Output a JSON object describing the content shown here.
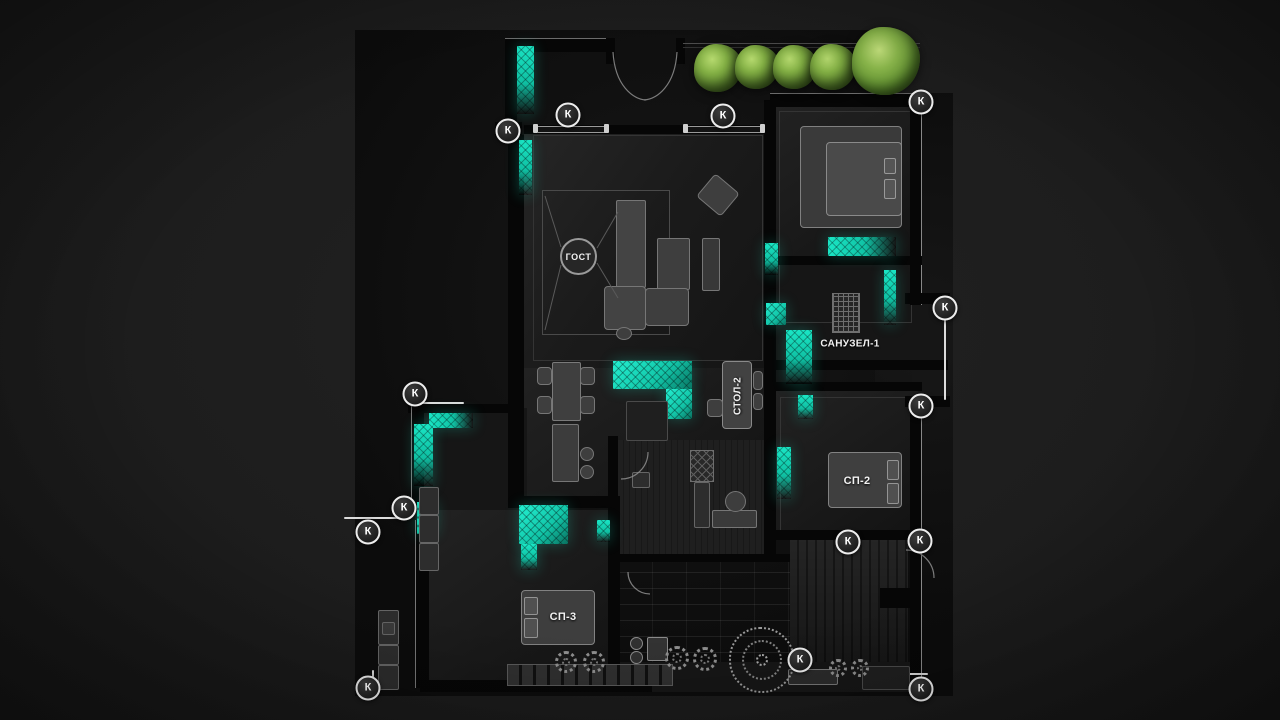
{
  "scene": {
    "type": "apartment-floor-plan-render",
    "background_color": "#1d1d1d",
    "accent_teal": "#1ae6c5",
    "tree_green": "#84b145"
  },
  "labels": {
    "living": "ГОСТ",
    "bathroom1": "САНУЗЕЛ-1",
    "table2": "СТОЛ-2",
    "bedroom2": "СП-2",
    "bedroom3": "СП-3"
  },
  "markers": {
    "letter": "К",
    "positions": [
      [
        508,
        131
      ],
      [
        568,
        115
      ],
      [
        723,
        116
      ],
      [
        921,
        102
      ],
      [
        945,
        308
      ],
      [
        921,
        406
      ],
      [
        415,
        394
      ],
      [
        404,
        508
      ],
      [
        368,
        532
      ],
      [
        848,
        542
      ],
      [
        920,
        541
      ],
      [
        800,
        660
      ],
      [
        921,
        689
      ],
      [
        368,
        688
      ]
    ]
  },
  "vegetation": {
    "bushes": [
      [
        718,
        68,
        24
      ],
      [
        757,
        67,
        22
      ],
      [
        795,
        67,
        22
      ],
      [
        833,
        67,
        23
      ]
    ],
    "tree": [
      886,
      61,
      34
    ],
    "gray_shrubs": [
      [
        566,
        662,
        22
      ],
      [
        594,
        662,
        22
      ],
      [
        677,
        658,
        24
      ],
      [
        705,
        659,
        24
      ],
      [
        838,
        668,
        18
      ],
      [
        860,
        668,
        18
      ]
    ],
    "big_plant": [
      762,
      660,
      66
    ]
  }
}
